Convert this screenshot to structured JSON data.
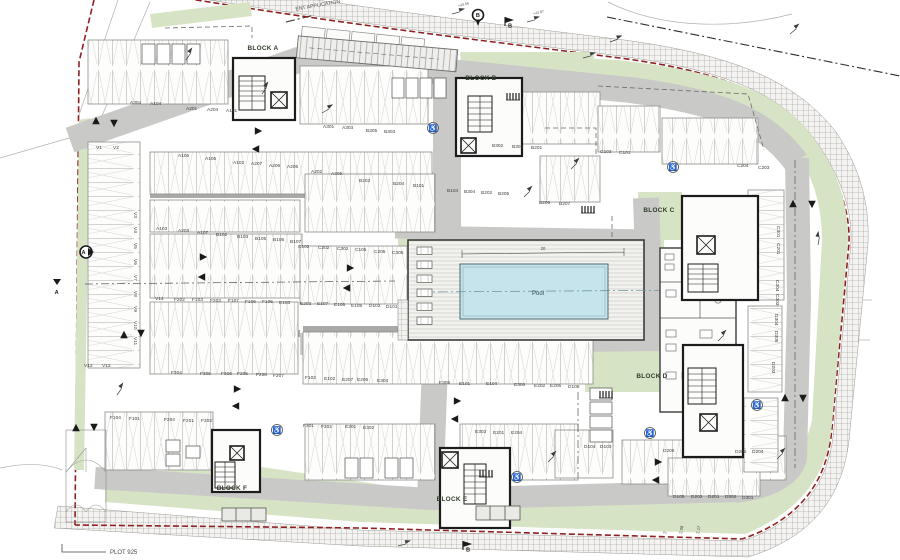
{
  "drawing": {
    "plot_label": "PLOT 925",
    "boundary_note_line1": "TO",
    "boundary_note_line2": "ENT APPLICATION"
  },
  "pool": {
    "label": "Pool",
    "length_dim": "20"
  },
  "colors": {
    "boundary_red": "#8e2020",
    "landscape_green": "#d7e3c5",
    "road_gray": "#c9c9c8",
    "wall_gray": "#a9a9a8",
    "pool_blue": "#c6e4ec",
    "core_dark": "#1c1c1c",
    "ink": "#3a3a38"
  },
  "block_labels": [
    {
      "t": "BLOCK A",
      "x": 263,
      "y": 50
    },
    {
      "t": "BLOCK B",
      "x": 481,
      "y": 80
    },
    {
      "t": "BLOCK C",
      "x": 659,
      "y": 212
    },
    {
      "t": "BLOCK D",
      "x": 652,
      "y": 378
    },
    {
      "t": "BLOCK E",
      "x": 452,
      "y": 501
    },
    {
      "t": "BLOCK F",
      "x": 232,
      "y": 490
    }
  ],
  "parking_labels": [
    {
      "t": "A304",
      "x": 130,
      "y": 104
    },
    {
      "t": "A104",
      "x": 150,
      "y": 105
    },
    {
      "t": "A201",
      "x": 186,
      "y": 110
    },
    {
      "t": "A204",
      "x": 207,
      "y": 111
    },
    {
      "t": "A101",
      "x": 226,
      "y": 112
    },
    {
      "t": "A301",
      "x": 323,
      "y": 128
    },
    {
      "t": "A303",
      "x": 342,
      "y": 129
    },
    {
      "t": "B305",
      "x": 366,
      "y": 132
    },
    {
      "t": "B303",
      "x": 384,
      "y": 133
    },
    {
      "t": "B302",
      "x": 492,
      "y": 147
    },
    {
      "t": "B301",
      "x": 512,
      "y": 148
    },
    {
      "t": "B201",
      "x": 531,
      "y": 149
    },
    {
      "t": "C103",
      "x": 600,
      "y": 153
    },
    {
      "t": "C101",
      "x": 619,
      "y": 154
    },
    {
      "t": "C204",
      "x": 737,
      "y": 167
    },
    {
      "t": "C203",
      "x": 758,
      "y": 169
    },
    {
      "t": "V1",
      "x": 96,
      "y": 149
    },
    {
      "t": "V2",
      "x": 113,
      "y": 149
    },
    {
      "t": "A105",
      "x": 178,
      "y": 157
    },
    {
      "t": "A106",
      "x": 205,
      "y": 160
    },
    {
      "t": "A102",
      "x": 233,
      "y": 164
    },
    {
      "t": "A207",
      "x": 251,
      "y": 165
    },
    {
      "t": "A206",
      "x": 269,
      "y": 167
    },
    {
      "t": "A205",
      "x": 287,
      "y": 168
    },
    {
      "t": "A202",
      "x": 311,
      "y": 173
    },
    {
      "t": "A305",
      "x": 331,
      "y": 175
    },
    {
      "t": "B203",
      "x": 359,
      "y": 182
    },
    {
      "t": "B204",
      "x": 393,
      "y": 185
    },
    {
      "t": "B101",
      "x": 413,
      "y": 187
    },
    {
      "t": "B104",
      "x": 447,
      "y": 192
    },
    {
      "t": "B304",
      "x": 464,
      "y": 193
    },
    {
      "t": "B202",
      "x": 481,
      "y": 194
    },
    {
      "t": "B205",
      "x": 498,
      "y": 195
    },
    {
      "t": "B206",
      "x": 539,
      "y": 204
    },
    {
      "t": "B207",
      "x": 559,
      "y": 205
    },
    {
      "t": "A103",
      "x": 156,
      "y": 230
    },
    {
      "t": "A203",
      "x": 178,
      "y": 232
    },
    {
      "t": "A107",
      "x": 197,
      "y": 234
    },
    {
      "t": "B102",
      "x": 216,
      "y": 236
    },
    {
      "t": "B103",
      "x": 237,
      "y": 238
    },
    {
      "t": "B105",
      "x": 255,
      "y": 240
    },
    {
      "t": "B106",
      "x": 273,
      "y": 241
    },
    {
      "t": "B107",
      "x": 290,
      "y": 243
    },
    {
      "t": "C102",
      "x": 298,
      "y": 248
    },
    {
      "t": "C202",
      "x": 318,
      "y": 249
    },
    {
      "t": "C302",
      "x": 337,
      "y": 250
    },
    {
      "t": "C105",
      "x": 355,
      "y": 251
    },
    {
      "t": "C205",
      "x": 374,
      "y": 253
    },
    {
      "t": "C305",
      "x": 392,
      "y": 254
    },
    {
      "t": "V14",
      "x": 155,
      "y": 300
    },
    {
      "t": "F202",
      "x": 174,
      "y": 301
    },
    {
      "t": "F103",
      "x": 192,
      "y": 301
    },
    {
      "t": "F203",
      "x": 210,
      "y": 302
    },
    {
      "t": "F107",
      "x": 228,
      "y": 302
    },
    {
      "t": "F106",
      "x": 245,
      "y": 303
    },
    {
      "t": "F105",
      "x": 262,
      "y": 303
    },
    {
      "t": "E103",
      "x": 279,
      "y": 304
    },
    {
      "t": "E203",
      "x": 300,
      "y": 305
    },
    {
      "t": "E107",
      "x": 317,
      "y": 305
    },
    {
      "t": "E106",
      "x": 334,
      "y": 306
    },
    {
      "t": "E105",
      "x": 351,
      "y": 307
    },
    {
      "t": "D102",
      "x": 369,
      "y": 307
    },
    {
      "t": "D101",
      "x": 386,
      "y": 308
    },
    {
      "t": "V3",
      "x": 134,
      "y": 212,
      "r": 90
    },
    {
      "t": "V4",
      "x": 134,
      "y": 227,
      "r": 90
    },
    {
      "t": "V5",
      "x": 134,
      "y": 243,
      "r": 90
    },
    {
      "t": "V6",
      "x": 134,
      "y": 259,
      "r": 90
    },
    {
      "t": "V7",
      "x": 134,
      "y": 275,
      "r": 90
    },
    {
      "t": "V8",
      "x": 134,
      "y": 291,
      "r": 90
    },
    {
      "t": "V9",
      "x": 134,
      "y": 306,
      "r": 90
    },
    {
      "t": "V10",
      "x": 134,
      "y": 321,
      "r": 90
    },
    {
      "t": "V11",
      "x": 134,
      "y": 337,
      "r": 90
    },
    {
      "t": "V12",
      "x": 84,
      "y": 367
    },
    {
      "t": "V13",
      "x": 102,
      "y": 367
    },
    {
      "t": "F304",
      "x": 171,
      "y": 374
    },
    {
      "t": "F305",
      "x": 200,
      "y": 375
    },
    {
      "t": "F306",
      "x": 221,
      "y": 375
    },
    {
      "t": "F205",
      "x": 237,
      "y": 375
    },
    {
      "t": "F206",
      "x": 256,
      "y": 376
    },
    {
      "t": "F207",
      "x": 273,
      "y": 377
    },
    {
      "t": "F102",
      "x": 305,
      "y": 379
    },
    {
      "t": "E102",
      "x": 324,
      "y": 380
    },
    {
      "t": "E207",
      "x": 342,
      "y": 381
    },
    {
      "t": "E206",
      "x": 357,
      "y": 381
    },
    {
      "t": "E304",
      "x": 377,
      "y": 382
    },
    {
      "t": "E305",
      "x": 439,
      "y": 384
    },
    {
      "t": "E101",
      "x": 459,
      "y": 385
    },
    {
      "t": "E104",
      "x": 486,
      "y": 385
    },
    {
      "t": "E306",
      "x": 514,
      "y": 386
    },
    {
      "t": "E202",
      "x": 534,
      "y": 387
    },
    {
      "t": "E205",
      "x": 550,
      "y": 387
    },
    {
      "t": "D108",
      "x": 568,
      "y": 388
    },
    {
      "t": "F104",
      "x": 110,
      "y": 419
    },
    {
      "t": "F101",
      "x": 129,
      "y": 420
    },
    {
      "t": "F204",
      "x": 164,
      "y": 421
    },
    {
      "t": "F201",
      "x": 183,
      "y": 422
    },
    {
      "t": "F303",
      "x": 201,
      "y": 422
    },
    {
      "t": "F301",
      "x": 303,
      "y": 427
    },
    {
      "t": "F302",
      "x": 321,
      "y": 428
    },
    {
      "t": "E301",
      "x": 345,
      "y": 428
    },
    {
      "t": "E302",
      "x": 363,
      "y": 429
    },
    {
      "t": "E303",
      "x": 475,
      "y": 433
    },
    {
      "t": "E201",
      "x": 493,
      "y": 434
    },
    {
      "t": "E204",
      "x": 511,
      "y": 434
    },
    {
      "t": "D104",
      "x": 584,
      "y": 448
    },
    {
      "t": "D103",
      "x": 600,
      "y": 448
    },
    {
      "t": "D206",
      "x": 663,
      "y": 452
    },
    {
      "t": "D205",
      "x": 735,
      "y": 453
    },
    {
      "t": "D204",
      "x": 752,
      "y": 453
    },
    {
      "t": "D105",
      "x": 673,
      "y": 498
    },
    {
      "t": "D202",
      "x": 691,
      "y": 498
    },
    {
      "t": "D201",
      "x": 708,
      "y": 498
    },
    {
      "t": "D302",
      "x": 725,
      "y": 498
    },
    {
      "t": "D301",
      "x": 742,
      "y": 499
    },
    {
      "t": "C301",
      "x": 777,
      "y": 226,
      "r": 90
    },
    {
      "t": "C201",
      "x": 777,
      "y": 243,
      "r": 90
    },
    {
      "t": "C304",
      "x": 776,
      "y": 280,
      "r": 90
    },
    {
      "t": "C303",
      "x": 776,
      "y": 294,
      "r": 90
    },
    {
      "t": "D304",
      "x": 775,
      "y": 314,
      "r": 90
    },
    {
      "t": "D305",
      "x": 775,
      "y": 331,
      "r": 90
    },
    {
      "t": "D203",
      "x": 772,
      "y": 362,
      "r": 90
    }
  ],
  "small_dims": [
    {
      "t": "2",
      "x": 666,
      "y": 534,
      "r": -80
    },
    {
      "t": "2.08",
      "x": 682,
      "y": 534,
      "r": -80
    },
    {
      "t": "2.17",
      "x": 699,
      "y": 534,
      "r": -80
    }
  ],
  "level_markers": [
    {
      "t": "+43.06",
      "x": 452,
      "y": 14,
      "r": -15
    },
    {
      "t": "+43.87",
      "x": 527,
      "y": 22,
      "r": -15
    },
    {
      "t": "",
      "x": 610,
      "y": 42,
      "r": -20
    },
    {
      "t": "",
      "x": 790,
      "y": 34,
      "r": -40
    },
    {
      "t": "",
      "x": 583,
      "y": 58,
      "r": -15
    },
    {
      "t": "",
      "x": 186,
      "y": 60,
      "r": -55
    },
    {
      "t": "",
      "x": 262,
      "y": 94,
      "r": -55
    },
    {
      "t": "",
      "x": 322,
      "y": 113,
      "r": -30
    },
    {
      "t": "",
      "x": 571,
      "y": 169,
      "r": -45
    },
    {
      "t": "",
      "x": 524,
      "y": 197,
      "r": -45
    },
    {
      "t": "",
      "x": 818,
      "y": 245,
      "r": -80
    },
    {
      "t": "",
      "x": 718,
      "y": 341,
      "r": -45
    },
    {
      "t": "",
      "x": 777,
      "y": 459,
      "r": -45
    },
    {
      "t": "",
      "x": 117,
      "y": 395,
      "r": -55
    },
    {
      "t": "",
      "x": 398,
      "y": 546,
      "r": -15
    },
    {
      "t": "",
      "x": 548,
      "y": 462,
      "r": -45
    }
  ],
  "section_markers": [
    {
      "t": "A",
      "x": 86,
      "y": 252,
      "kind": "circle"
    },
    {
      "t": "A",
      "x": 57,
      "y": 282,
      "kind": "edge"
    },
    {
      "t": "B",
      "x": 478,
      "y": 15,
      "kind": "pin"
    },
    {
      "t": "B",
      "x": 505,
      "y": 26,
      "kind": "flag"
    },
    {
      "t": "B",
      "x": 463,
      "y": 550,
      "kind": "flag"
    }
  ],
  "arrows": [
    {
      "x": 96,
      "y": 121,
      "r": 0
    },
    {
      "x": 114,
      "y": 123,
      "r": 180
    },
    {
      "x": 258,
      "y": 131,
      "r": 90
    },
    {
      "x": 256,
      "y": 149,
      "r": 270
    },
    {
      "x": 203,
      "y": 257,
      "r": 90
    },
    {
      "x": 202,
      "y": 277,
      "r": 270
    },
    {
      "x": 350,
      "y": 268,
      "r": 90
    },
    {
      "x": 347,
      "y": 288,
      "r": 270
    },
    {
      "x": 124,
      "y": 335,
      "r": 0
    },
    {
      "x": 141,
      "y": 333,
      "r": 180
    },
    {
      "x": 457,
      "y": 401,
      "r": 90
    },
    {
      "x": 455,
      "y": 419,
      "r": 270
    },
    {
      "x": 793,
      "y": 204,
      "r": 0
    },
    {
      "x": 812,
      "y": 204,
      "r": 180
    },
    {
      "x": 785,
      "y": 398,
      "r": 0
    },
    {
      "x": 803,
      "y": 398,
      "r": 180
    },
    {
      "x": 658,
      "y": 462,
      "r": 90
    },
    {
      "x": 656,
      "y": 480,
      "r": 270
    },
    {
      "x": 76,
      "y": 428,
      "r": 0
    },
    {
      "x": 94,
      "y": 427,
      "r": 180
    },
    {
      "x": 237,
      "y": 389,
      "r": 90
    },
    {
      "x": 236,
      "y": 406,
      "r": 270
    }
  ],
  "accessible_spaces": [
    {
      "x": 433,
      "y": 128
    },
    {
      "x": 673,
      "y": 167
    },
    {
      "x": 757,
      "y": 405
    },
    {
      "x": 650,
      "y": 433
    },
    {
      "x": 517,
      "y": 477
    },
    {
      "x": 277,
      "y": 430
    }
  ],
  "bike_racks": [
    {
      "x": 507,
      "y": 100
    },
    {
      "x": 582,
      "y": 213
    },
    {
      "x": 600,
      "y": 398
    },
    {
      "x": 480,
      "y": 477
    }
  ],
  "loungers": [
    {
      "x": 417,
      "y": 247
    },
    {
      "x": 417,
      "y": 261
    },
    {
      "x": 417,
      "y": 275
    },
    {
      "x": 417,
      "y": 289
    },
    {
      "x": 417,
      "y": 303
    },
    {
      "x": 417,
      "y": 317
    }
  ]
}
